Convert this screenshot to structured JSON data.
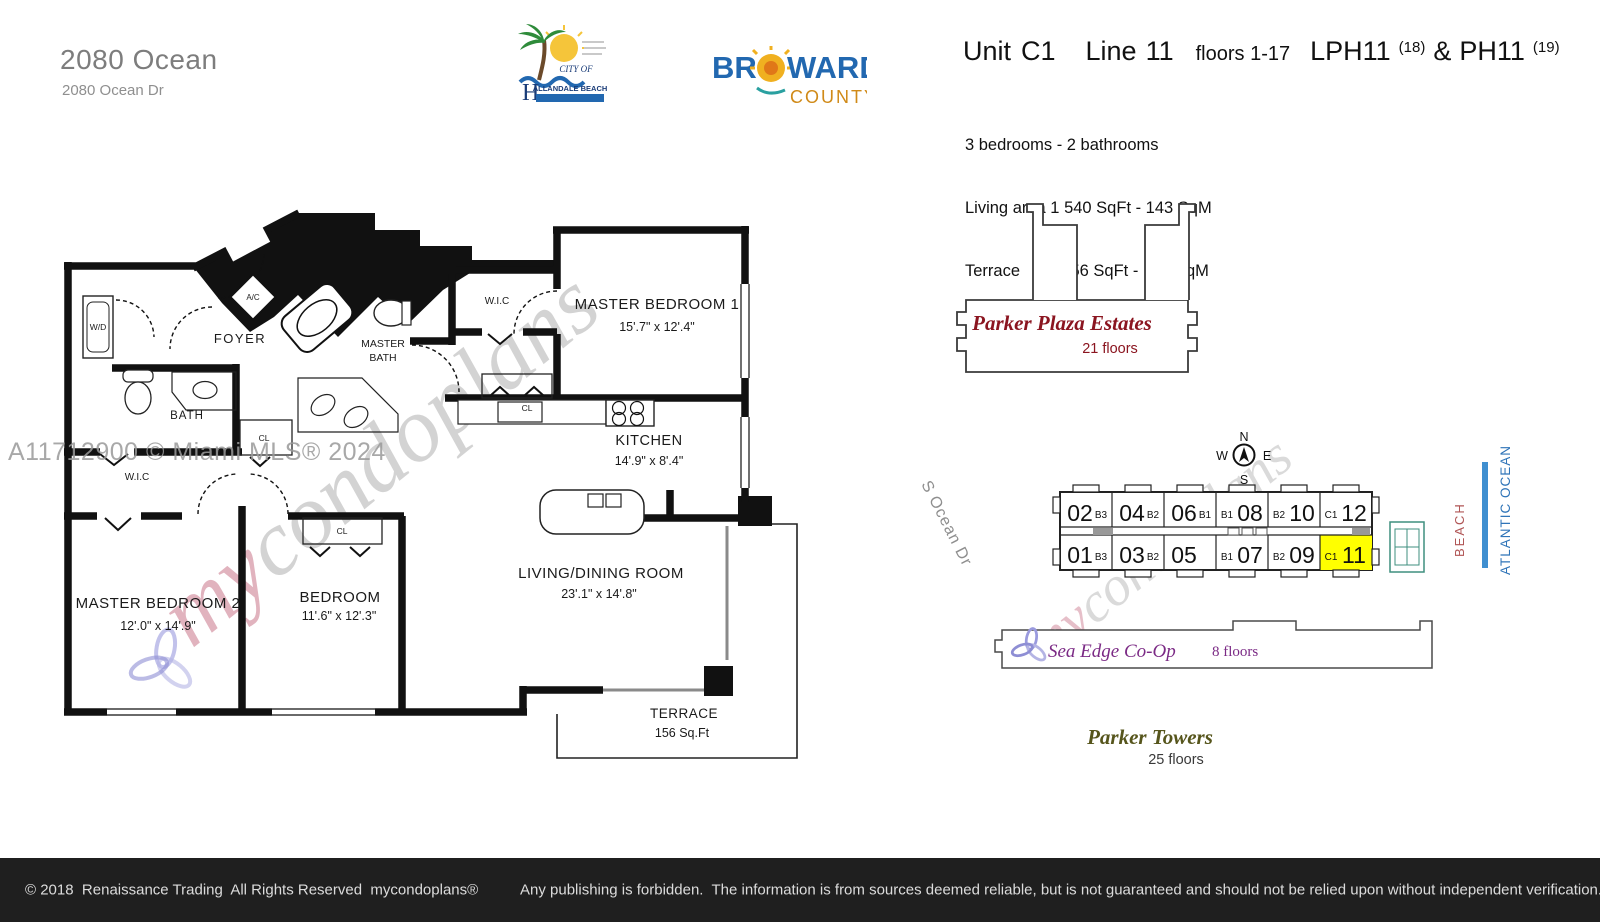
{
  "header": {
    "building_name": "2080 Ocean",
    "address": "2080 Ocean Dr",
    "unit_label": "Unit",
    "unit_value": "C1",
    "line_label": "Line",
    "line_value": "11",
    "floors_text": "floors 1-17",
    "lph_text": "LPH11",
    "lph_sup": "(18)",
    "amp": "&",
    "ph_text": "PH11",
    "ph_sup": "(19)",
    "bed_bath": "3 bedrooms - 2 bathrooms",
    "living_area": "Living area 1 540 SqFt - 143 SqM",
    "terrace_line": "Terrace         156 SqFt -   15 SqM"
  },
  "logos": {
    "hallandale": {
      "city_of": "CITY OF",
      "h": "H",
      "name": "ALLANDALE BEACH"
    },
    "broward": {
      "br": "BR",
      "ward": "WARD",
      "county": "COUNTY"
    }
  },
  "floorplan": {
    "master_bedroom_1": {
      "name": "MASTER BEDROOM 1",
      "dims": "15'.7\" x 12'.4\""
    },
    "master_bedroom_2": {
      "name": "MASTER BEDROOM  2",
      "dims": "12'.0\" x 14'.9\""
    },
    "bedroom": {
      "name": "BEDROOM",
      "dims": "11'.6\" x 12'.3\""
    },
    "living_dining": {
      "name": "LIVING/DINING  ROOM",
      "dims": "23'.1\" x 14'.8\""
    },
    "kitchen": {
      "name": "KITCHEN",
      "dims": "14'.9\" x 8'.4\""
    },
    "terrace": {
      "name": "TERRACE",
      "area": "156 Sq.Ft"
    },
    "foyer": "FOYER",
    "bath": "BATH",
    "master_bath_line1": "MASTER",
    "master_bath_line2": "BATH",
    "wic_top": "W.I.C",
    "wic_2": "W.I.C",
    "wd": "W/D",
    "ac": "A/C",
    "cl_kitchen": "CL",
    "cl_bath": "CL",
    "cl_bedroom": "CL"
  },
  "watermarks": {
    "mls": "A11712900 © Miami MLS® 2024",
    "brand_my": "my",
    "brand_rest": "condoplans"
  },
  "site_map": {
    "parker_plaza": {
      "name": "Parker Plaza Estates",
      "floors": "21 floors"
    },
    "compass": {
      "n": "N",
      "e": "E",
      "s": "S",
      "w": "W"
    },
    "street": "S Ocean Dr",
    "beach": "BEACH",
    "ocean": "ATLANTIC OCEAN",
    "strip": {
      "top_units": [
        {
          "number": "02",
          "code": "B3"
        },
        {
          "number": "04",
          "code": "B2"
        },
        {
          "number": "06",
          "code": "B1"
        },
        {
          "number": "08",
          "code": "B1"
        },
        {
          "number": "10",
          "code": "B2"
        },
        {
          "number": "12",
          "code": "C1"
        }
      ],
      "bottom_units": [
        {
          "number": "01",
          "code": "B3"
        },
        {
          "number": "03",
          "code": "B2"
        },
        {
          "number": "05",
          "code": ""
        },
        {
          "number": "07",
          "code": "B1"
        },
        {
          "number": "09",
          "code": "B2"
        },
        {
          "number": "11",
          "code": "C1"
        }
      ]
    },
    "sea_edge": {
      "name": "Sea Edge Co-Op",
      "floors": "8 floors"
    },
    "parker_towers": {
      "name": "Parker Towers",
      "floors": "25 floors"
    }
  },
  "colors": {
    "highlight": "#ffff00",
    "plaza_red": "#8b1520",
    "sea_edge_purple": "#7b2a85",
    "towers_olive": "#56551c",
    "beach_red": "#b05555",
    "ocean_blue": "#2f74b8",
    "bar_blue": "#3f8fd0",
    "tennis_green": "#3f8f7f",
    "broward_blue": "#2268b0",
    "broward_orange": "#d08a18"
  },
  "footer": {
    "left": "© 2018  Renaissance Trading  All Rights Reserved  mycondoplans®",
    "right": "Any publishing is forbidden.  The information is from sources deemed reliable, but is not guaranteed and should not be relied upon without independent verification."
  }
}
